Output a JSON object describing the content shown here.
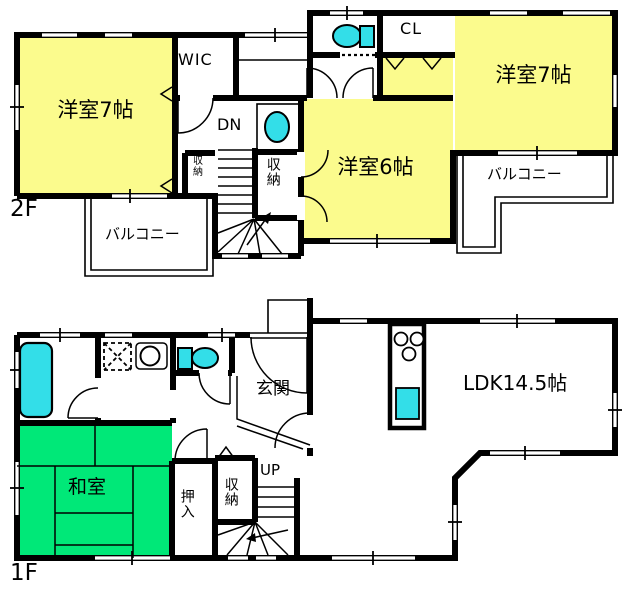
{
  "title": "2-story house floor plan",
  "colors": {
    "wall": "#000000",
    "room_yellow": "#FBFB8D",
    "room_green": "#00E878",
    "fixture_cyan": "#33DEE8",
    "background": "#FFFFFF"
  },
  "floor2": {
    "label": "2F",
    "bedroom_west": "洋室7帖",
    "bedroom_east": "洋室7帖",
    "bedroom_south": "洋室6帖",
    "wic": "WIC",
    "closet_hall": "収納",
    "closet_stairs": "収納",
    "closet_cl": "CL",
    "stairs_dn": "DN",
    "balcony_west": "バルコニー",
    "balcony_east": "バルコニー"
  },
  "floor1": {
    "label": "1F",
    "entrance": "玄関",
    "tatami": "和室",
    "oshiire": "押入",
    "closet": "収納",
    "stairs_up": "UP",
    "ldk": "LDK14.5帖"
  }
}
